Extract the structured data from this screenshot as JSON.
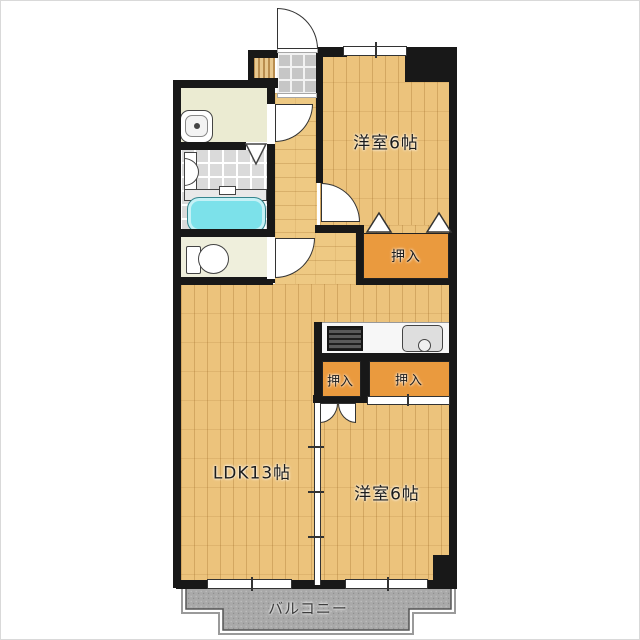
{
  "title": "apartment-floor-plan",
  "rooms": {
    "bedroom_top": {
      "label": "洋室6帖"
    },
    "bedroom_bottom": {
      "label": "洋室6帖"
    },
    "ldk": {
      "label": "LDK13帖"
    },
    "closet_top": {
      "label": "押入"
    },
    "closet_mid_left": {
      "label": "押入"
    },
    "closet_mid_right": {
      "label": "押入"
    },
    "balcony": {
      "label": "バルコニー"
    }
  },
  "icons": [
    "front-door-swing",
    "washroom-door-swing",
    "bedroom-door-swing",
    "toilet-door-swing",
    "closet-double-door",
    "closet-sliding-door",
    "closet-door-triangles",
    "folding-bath-door",
    "bathtub",
    "toilet",
    "washbasin",
    "gas-stove",
    "kitchen-sink",
    "entrance-tile",
    "wood-step",
    "window",
    "sliding-partition"
  ],
  "colors": {
    "wall": "#181818",
    "wood_floor": "#ecc37c",
    "closet_fill": "#ea9a3e",
    "bathtub_fill": "#7ce1ea",
    "balcony_fill": "#a9a9a9",
    "washroom_fill": "#ebebd2",
    "tile_fill": "#dadada"
  }
}
